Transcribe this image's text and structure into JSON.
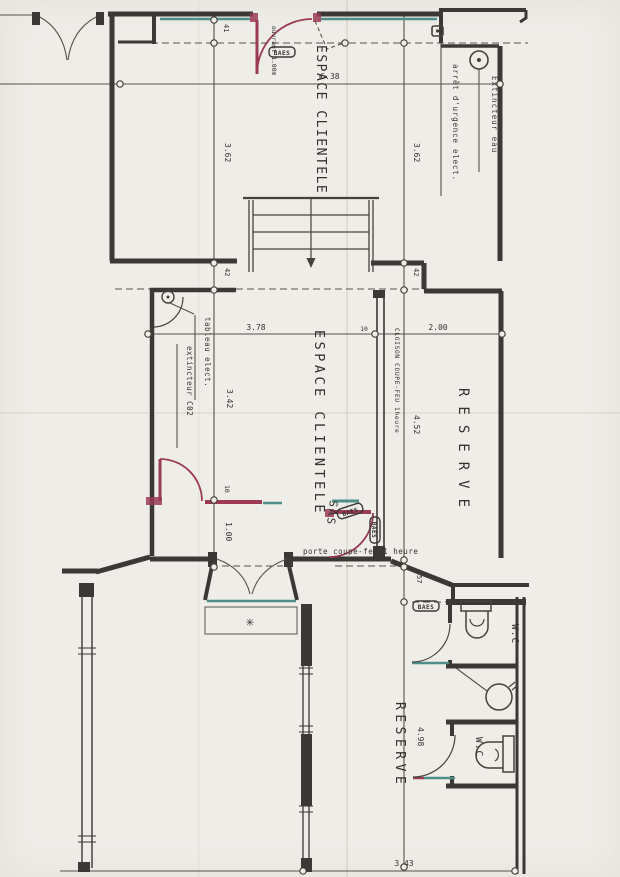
{
  "document": {
    "kind": "scanned architectural floor plan",
    "language": "fr"
  },
  "rooms": {
    "espace_top": "ESPACE CLIENTELE",
    "espace_mid": "ESPACE CLIENTELE",
    "reserve_mid": "RESERVE",
    "reserve_bottom": "RESERVE",
    "sas": "SAS",
    "wc_top": "W.C",
    "wc_bottom": "W.C"
  },
  "annotations": {
    "extincteur_eau": "Extincteur eau",
    "arret_urgence": "arrêt d'urgence elect.",
    "tableau_elect": "tableau elect.",
    "extincteur_co2": "extincteur C02",
    "cloison": "CLOISON COUPE-FEU 1heure",
    "porte_coupe_feu": "porte coupe-feu 1 heure",
    "ouvrant": "ouvrant 1.00m",
    "baes": "BAES"
  },
  "dimensions": {
    "top_width": "6.38",
    "left_height_top": "3.62",
    "right_height_top": "3.62",
    "wall_41": "41",
    "wall_42_left": "42",
    "wall_42_right": "42",
    "mid_width_left": "3.78",
    "cloison_thickness": "10",
    "reserve_width": "2.00",
    "mid_height_left": "3.42",
    "reserve_height": "4.52",
    "door_jamb": "10",
    "door_width": "1.00",
    "front_depth": "57",
    "bottom_height": "4.98",
    "bottom_width": "3.43"
  },
  "symbols": {
    "vent": "✳"
  },
  "colors": {
    "paper": "#efede8",
    "ink": "#3b3835",
    "fire_red": "#9c3a55",
    "glazing_teal": "#4e8f8a"
  }
}
